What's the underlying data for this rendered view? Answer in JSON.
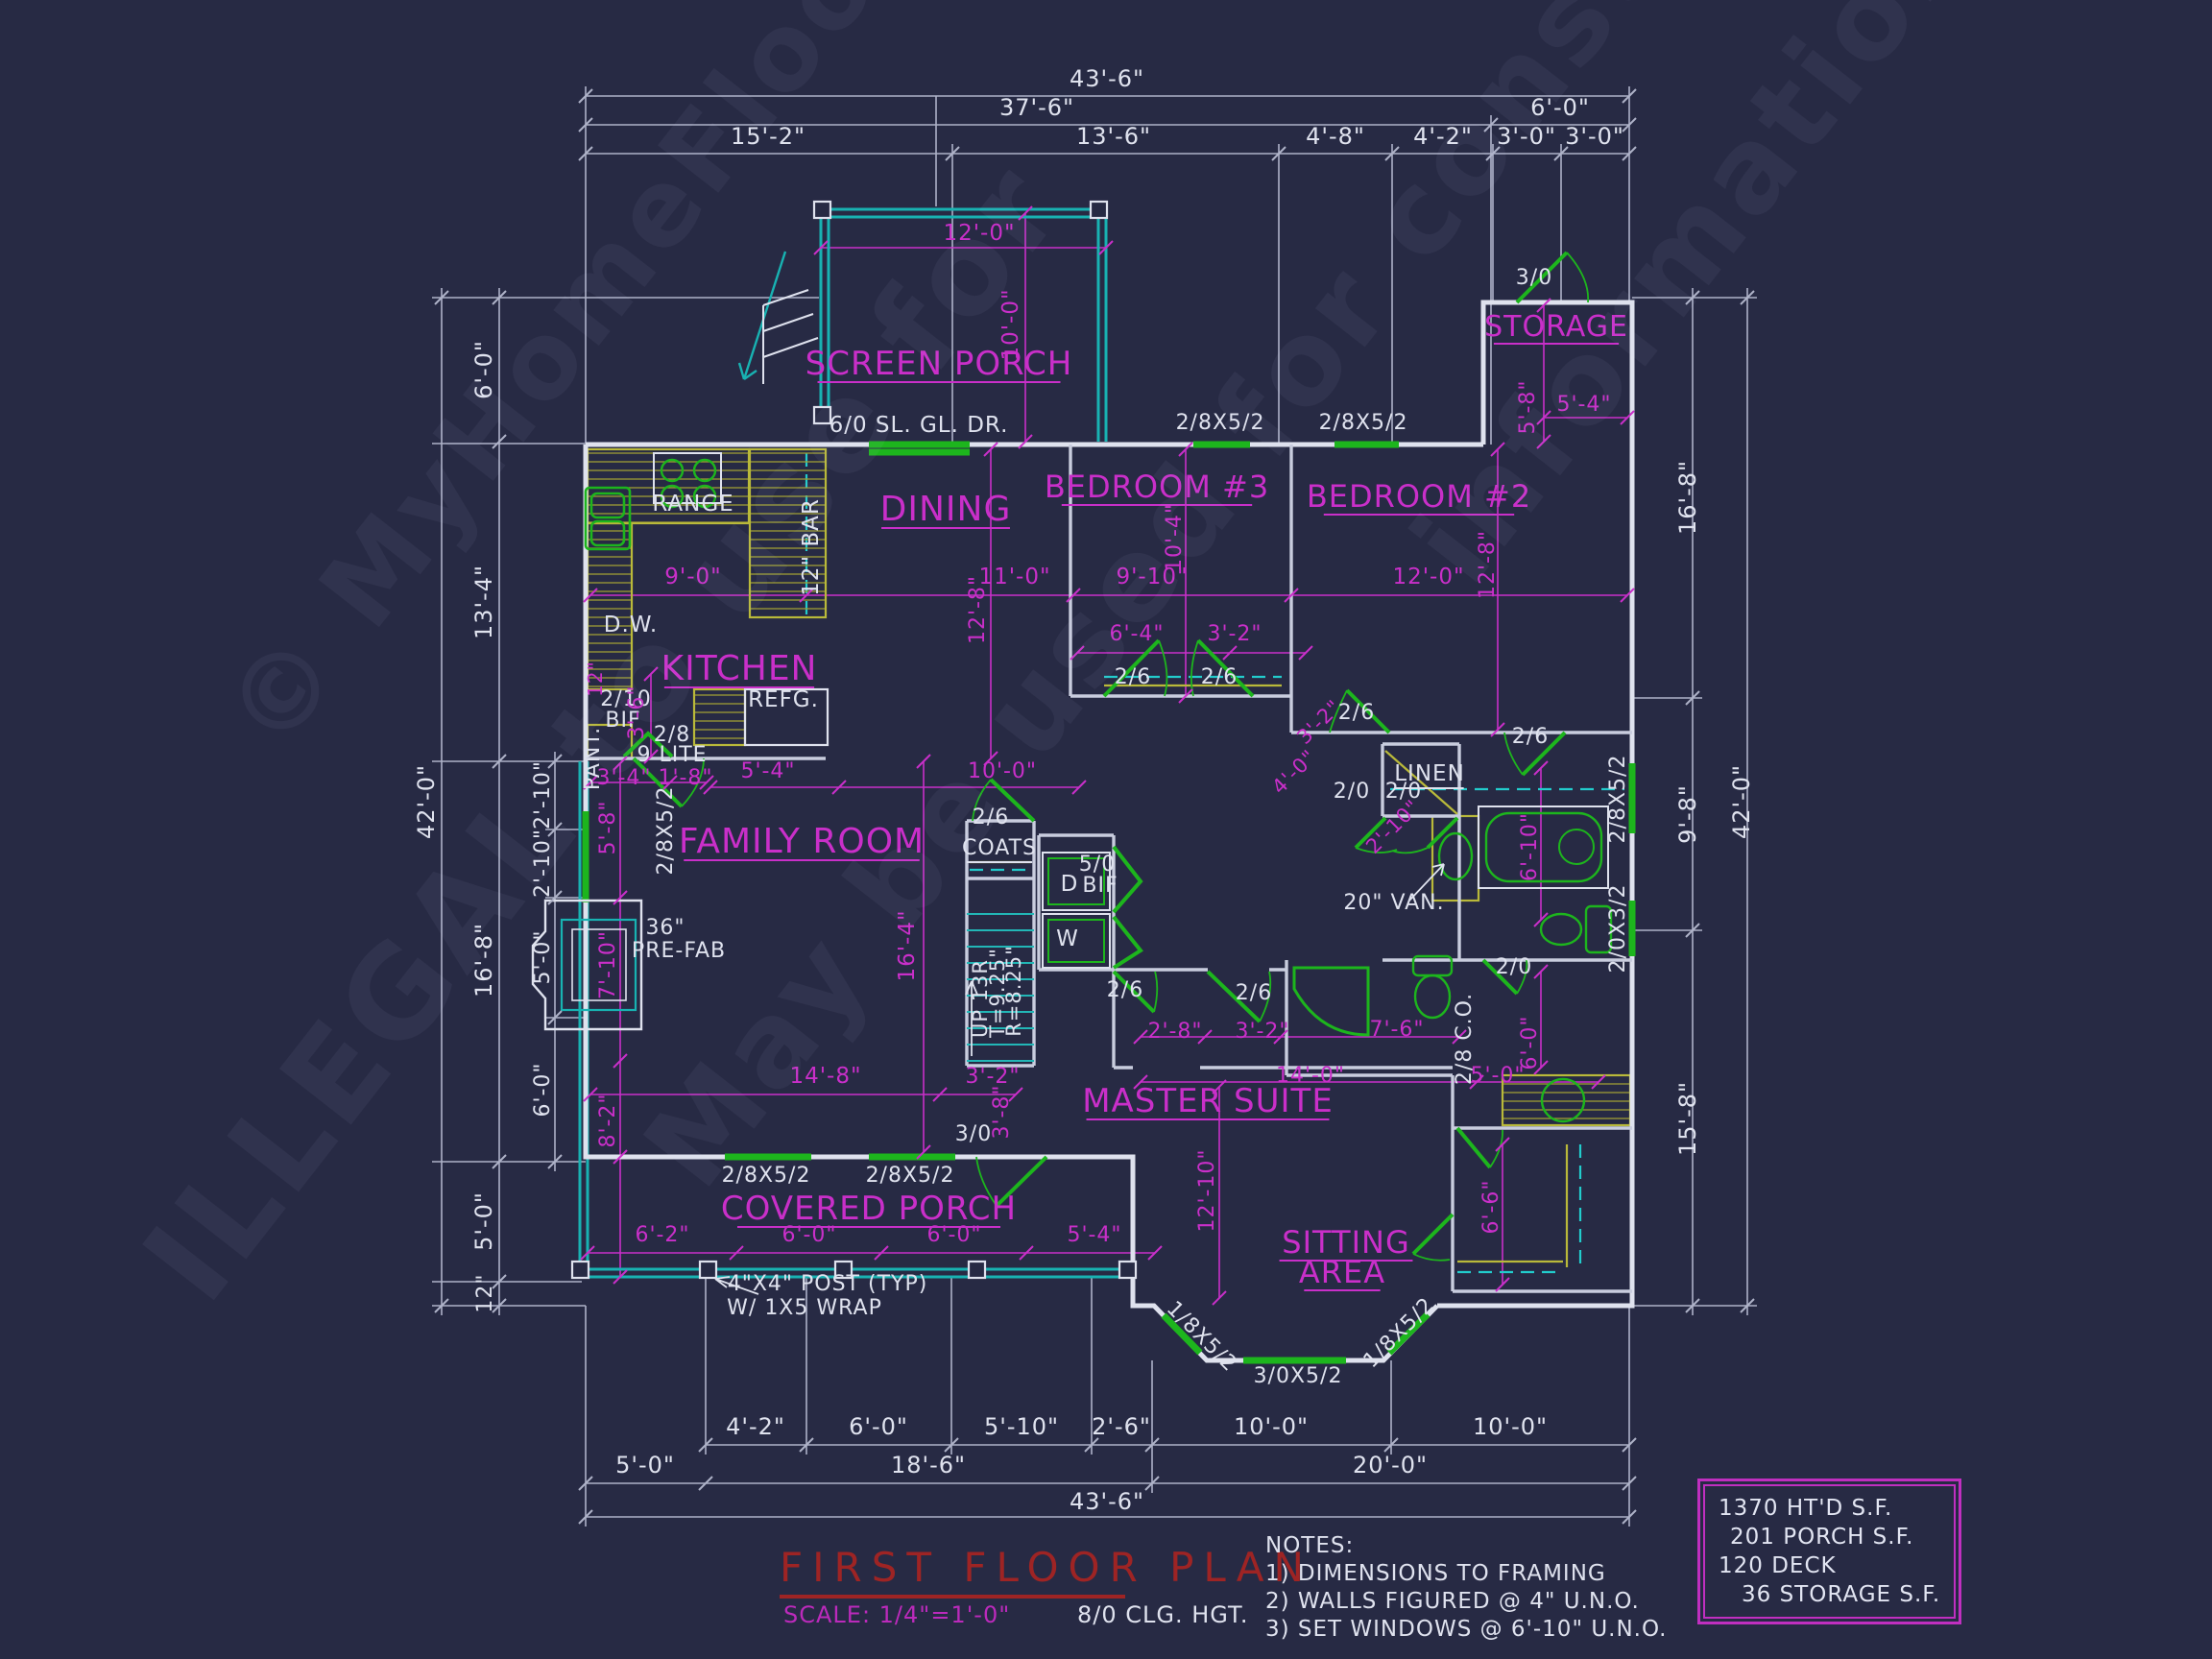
{
  "colors": {
    "background": "#272a44",
    "wall_white": "#dfe2ee",
    "dim_white": "#aeb2c8",
    "magenta": "#c92fc9",
    "green": "#1db51d",
    "cyan": "#18b2b2",
    "yellow": "#b9b93a",
    "title_red": "#9e2424"
  },
  "title_block": {
    "title": "FIRST FLOOR PLAN",
    "scale": "SCALE: 1/4\"=1'-0\"",
    "ceiling": "8/0 CLG. HGT."
  },
  "notes": {
    "heading": "NOTES:",
    "items": [
      "1)  DIMENSIONS TO FRAMING",
      "2) WALLS FIGURED @ 4\" U.N.O.",
      "3) SET WINDOWS @ 6'-10\" U.N.O."
    ]
  },
  "area_summary": {
    "lines": [
      "1370 HT'D S.F.",
      "201 PORCH S.F.",
      "120 DECK",
      "36 STORAGE S.F."
    ]
  },
  "watermark": {
    "lines": [
      "© MyHomeFloorPlans.com",
      "ILLEGAL to use for",
      "May be used for constructions",
      "informations"
    ]
  },
  "plan": {
    "labels": [
      [
        "43'-6\"",
        1153,
        90,
        24,
        "w",
        0,
        0
      ],
      [
        "37'-6\"",
        1080,
        120,
        24,
        "w",
        0,
        0
      ],
      [
        "6'-0\"",
        1625,
        120,
        24,
        "w",
        0,
        0
      ],
      [
        "15'-2\"",
        800,
        150,
        24,
        "w",
        0,
        0
      ],
      [
        "13'-6\"",
        1160,
        150,
        24,
        "w",
        0,
        0
      ],
      [
        "4'-8\"",
        1391,
        150,
        24,
        "w",
        0,
        0
      ],
      [
        "4'-2\"",
        1503,
        150,
        24,
        "w",
        0,
        0
      ],
      [
        "3'-0\"",
        1590,
        150,
        24,
        "w",
        0,
        0
      ],
      [
        "3'-0\"",
        1661,
        150,
        24,
        "w",
        0,
        0
      ],
      [
        "42'-0\"",
        452,
        835,
        24,
        "w",
        -90,
        0
      ],
      [
        "6'-0\"",
        512,
        385,
        24,
        "w",
        -90,
        0
      ],
      [
        "13'-4\"",
        512,
        627,
        24,
        "w",
        -90,
        0
      ],
      [
        "16'-8\"",
        512,
        1000,
        24,
        "w",
        -90,
        0
      ],
      [
        "5'-0\"",
        512,
        1272,
        24,
        "w",
        -90,
        0
      ],
      [
        "12\"",
        512,
        1347,
        22,
        "w",
        -90,
        0
      ],
      [
        "2'-10\"",
        572,
        828,
        22,
        "w",
        -90,
        0
      ],
      [
        "2'-10\"",
        572,
        899,
        22,
        "w",
        -90,
        0
      ],
      [
        "5'-0\"",
        572,
        997,
        22,
        "w",
        -90,
        0
      ],
      [
        "6'-0\"",
        572,
        1135,
        22,
        "w",
        -90,
        0
      ],
      [
        "16'-8\"",
        1766,
        518,
        24,
        "w",
        -90,
        0
      ],
      [
        "9'-8\"",
        1766,
        848,
        24,
        "w",
        -90,
        0
      ],
      [
        "15'-8\"",
        1766,
        1165,
        24,
        "w",
        -90,
        0
      ],
      [
        "42'-0\"",
        1822,
        835,
        24,
        "w",
        -90,
        0
      ],
      [
        "2/8X5/2",
        1692,
        832,
        22,
        "w",
        -90,
        0
      ],
      [
        "2/0X3/2",
        1692,
        967,
        22,
        "w",
        -90,
        0
      ],
      [
        "4'-2\"",
        787,
        1494,
        24,
        "w",
        0,
        0
      ],
      [
        "6'-0\"",
        915,
        1494,
        24,
        "w",
        0,
        0
      ],
      [
        "5'-10\"",
        1064,
        1494,
        24,
        "w",
        0,
        0
      ],
      [
        "2'-6\"",
        1168,
        1494,
        24,
        "w",
        0,
        0
      ],
      [
        "10'-0\"",
        1324,
        1494,
        24,
        "w",
        0,
        0
      ],
      [
        "10'-0\"",
        1573,
        1494,
        24,
        "w",
        0,
        0
      ],
      [
        "5'-0\"",
        672,
        1534,
        24,
        "w",
        0,
        0
      ],
      [
        "18'-6\"",
        967,
        1534,
        24,
        "w",
        0,
        0
      ],
      [
        "20'-0\"",
        1448,
        1534,
        24,
        "w",
        0,
        0
      ],
      [
        "43'-6\"",
        1153,
        1572,
        24,
        "w",
        0,
        0
      ],
      [
        "6/0 SL. GL. DR.",
        957,
        450,
        23,
        "w",
        0,
        0
      ],
      [
        "RANGE",
        722,
        532,
        23,
        "w",
        0,
        0
      ],
      [
        "D.W.",
        657,
        658,
        23,
        "w",
        0,
        0
      ],
      [
        "PANT.",
        624,
        790,
        22,
        "w",
        -90,
        0
      ],
      [
        "2/10",
        652,
        735,
        22,
        "w",
        0,
        0
      ],
      [
        "BIF",
        649,
        757,
        22,
        "w",
        0,
        0
      ],
      [
        "2/8",
        700,
        772,
        22,
        "w",
        0,
        0
      ],
      [
        "9 LITE",
        700,
        793,
        22,
        "w",
        0,
        0
      ],
      [
        "REFG.",
        816,
        736,
        23,
        "w",
        0,
        0
      ],
      [
        "12\" BAR",
        852,
        570,
        23,
        "w",
        -90,
        0
      ],
      [
        "36\"",
        693,
        973,
        22,
        "w",
        0,
        0
      ],
      [
        "PRE-FAB",
        707,
        997,
        22,
        "w",
        0,
        0
      ],
      [
        "2/8X5/2",
        700,
        865,
        22,
        "w",
        -90,
        0
      ],
      [
        "3/0",
        1598,
        296,
        22,
        "w",
        0,
        0
      ],
      [
        "2/6",
        1180,
        712,
        22,
        "w",
        0,
        0
      ],
      [
        "2/6",
        1270,
        712,
        22,
        "w",
        0,
        0
      ],
      [
        "2/6",
        1413,
        749,
        22,
        "w",
        0,
        0
      ],
      [
        "2/6",
        1594,
        774,
        22,
        "w",
        0,
        0
      ],
      [
        "2/0",
        1408,
        831,
        22,
        "w",
        0,
        0
      ],
      [
        "2/0",
        1462,
        831,
        22,
        "w",
        0,
        0
      ],
      [
        "LINEN",
        1489,
        813,
        23,
        "w",
        0,
        1
      ],
      [
        "20\" VAN.",
        1452,
        947,
        22,
        "w",
        0,
        0
      ],
      [
        "2/0",
        1577,
        1014,
        22,
        "w",
        0,
        0
      ],
      [
        "2/6",
        1032,
        858,
        22,
        "w",
        0,
        0
      ],
      [
        "COATS",
        1041,
        890,
        22,
        "w",
        0,
        1
      ],
      [
        "UP 13R",
        1028,
        1040,
        21,
        "w",
        -90,
        0
      ],
      [
        "T=9.25\"",
        1046,
        1034,
        21,
        "w",
        -90,
        0
      ],
      [
        "R=8.25\"",
        1063,
        1032,
        21,
        "w",
        -90,
        0
      ],
      [
        "D",
        1114,
        928,
        23,
        "w",
        0,
        0
      ],
      [
        "W",
        1112,
        985,
        23,
        "w",
        0,
        0
      ],
      [
        "5/0",
        1143,
        907,
        22,
        "w",
        0,
        0
      ],
      [
        "BIF",
        1146,
        929,
        22,
        "w",
        0,
        0
      ],
      [
        "2/6",
        1172,
        1038,
        22,
        "w",
        0,
        0
      ],
      [
        "2/6",
        1306,
        1041,
        22,
        "w",
        0,
        0
      ],
      [
        "2/8 C.O.",
        1532,
        1082,
        22,
        "w",
        -90,
        0
      ],
      [
        "3/0",
        1014,
        1188,
        22,
        "w",
        0,
        0
      ],
      [
        "2/8X5/2",
        798,
        1231,
        22,
        "w",
        0,
        0
      ],
      [
        "2/8X5/2",
        948,
        1231,
        22,
        "w",
        0,
        0
      ],
      [
        "2/8X5/2",
        1271,
        447,
        22,
        "w",
        0,
        0
      ],
      [
        "2/8X5/2",
        1420,
        447,
        22,
        "w",
        0,
        0
      ],
      [
        "1/8X5/2",
        1247,
        1397,
        22,
        "w",
        45,
        0
      ],
      [
        "3/0X5/2",
        1352,
        1440,
        22,
        "w",
        0,
        0
      ],
      [
        "1/8X5/2",
        1462,
        1393,
        22,
        "w",
        -45,
        0
      ],
      [
        "4\"X4\" POST (TYP)",
        862,
        1344,
        22,
        "w",
        0,
        0
      ],
      [
        "W/ 1X5 WRAP",
        838,
        1369,
        22,
        "w",
        0,
        0
      ],
      [
        "12'-0\"",
        1020,
        250,
        23,
        "m",
        0,
        0
      ],
      [
        "10'-0\"",
        1060,
        338,
        23,
        "m",
        -90,
        0
      ],
      [
        "5'-8\"",
        1598,
        424,
        22,
        "m",
        -90,
        0
      ],
      [
        "5'-4\"",
        1650,
        428,
        22,
        "m",
        0,
        0
      ],
      [
        "9'-0\"",
        722,
        608,
        23,
        "m",
        0,
        0
      ],
      [
        "11'-0\"",
        1057,
        608,
        23,
        "m",
        0,
        0
      ],
      [
        "12'-8\"",
        1025,
        635,
        22,
        "m",
        -90,
        0
      ],
      [
        "3'-6\"",
        670,
        742,
        22,
        "m",
        -90,
        0
      ],
      [
        "12\"",
        627,
        707,
        20,
        "m",
        -90,
        0
      ],
      [
        "3'-4\"",
        650,
        817,
        22,
        "m",
        0,
        0
      ],
      [
        "1'-8\"",
        714,
        817,
        22,
        "m",
        0,
        0
      ],
      [
        "5'-4\"",
        800,
        810,
        22,
        "m",
        0,
        0
      ],
      [
        "10'-0\"",
        1044,
        810,
        22,
        "m",
        0,
        0
      ],
      [
        "9'-10\"",
        1200,
        608,
        23,
        "m",
        0,
        0
      ],
      [
        "10'-4\"",
        1230,
        560,
        22,
        "m",
        -90,
        0
      ],
      [
        "6'-4\"",
        1184,
        667,
        22,
        "m",
        0,
        0
      ],
      [
        "3'-2\"",
        1286,
        667,
        22,
        "m",
        0,
        0
      ],
      [
        "12'-0\"",
        1488,
        608,
        23,
        "m",
        0,
        0
      ],
      [
        "12'-8\"",
        1556,
        588,
        22,
        "m",
        -90,
        0
      ],
      [
        "3'-2\"",
        1379,
        757,
        21,
        "m",
        -45,
        0
      ],
      [
        "4'-0\"",
        1353,
        809,
        21,
        "m",
        -45,
        0
      ],
      [
        "2'-10\"",
        1456,
        866,
        21,
        "m",
        -45,
        0
      ],
      [
        "6'-10\"",
        1600,
        882,
        22,
        "m",
        -90,
        0
      ],
      [
        "16'-4\"",
        952,
        985,
        23,
        "m",
        -90,
        0
      ],
      [
        "14'-8\"",
        860,
        1128,
        23,
        "m",
        0,
        0
      ],
      [
        "3'-2\"",
        1034,
        1128,
        22,
        "m",
        0,
        0
      ],
      [
        "3'-8\"",
        1050,
        1158,
        22,
        "m",
        -90,
        0
      ],
      [
        "2'-8\"",
        1224,
        1081,
        22,
        "m",
        0,
        0
      ],
      [
        "3'-2\"",
        1315,
        1081,
        22,
        "m",
        0,
        0
      ],
      [
        "7'-6\"",
        1455,
        1079,
        22,
        "m",
        0,
        0
      ],
      [
        "14'-0\"",
        1365,
        1127,
        22,
        "m",
        0,
        0
      ],
      [
        "5'-0\"",
        1560,
        1127,
        22,
        "m",
        0,
        0
      ],
      [
        "6'-0\"",
        1600,
        1086,
        22,
        "m",
        -90,
        0
      ],
      [
        "12'-10\"",
        1264,
        1240,
        22,
        "m",
        -90,
        0
      ],
      [
        "6'-6\"",
        1560,
        1257,
        22,
        "m",
        -90,
        0
      ],
      [
        "5'-8\"",
        640,
        862,
        22,
        "m",
        -90,
        0
      ],
      [
        "7'-10\"",
        640,
        1005,
        22,
        "m",
        -90,
        0
      ],
      [
        "8'-2\"",
        640,
        1167,
        22,
        "m",
        -90,
        0
      ],
      [
        "6'-2\"",
        690,
        1293,
        22,
        "m",
        0,
        0
      ],
      [
        "6'-0\"",
        843,
        1293,
        22,
        "m",
        0,
        0
      ],
      [
        "6'-0\"",
        994,
        1293,
        22,
        "m",
        0,
        0
      ],
      [
        "5'-4\"",
        1140,
        1293,
        22,
        "m",
        0,
        0
      ],
      [
        "SCREEN PORCH",
        978,
        390,
        34,
        "m",
        0,
        1
      ],
      [
        "STORAGE",
        1621,
        350,
        30,
        "m",
        0,
        1
      ],
      [
        "DINING",
        985,
        542,
        36,
        "m",
        0,
        1
      ],
      [
        "KITCHEN",
        770,
        708,
        36,
        "m",
        0,
        1
      ],
      [
        "FAMILY ROOM",
        835,
        888,
        36,
        "m",
        0,
        1
      ],
      [
        "BEDROOM #3",
        1205,
        518,
        32,
        "m",
        0,
        1
      ],
      [
        "BEDROOM #2",
        1478,
        528,
        32,
        "m",
        0,
        1
      ],
      [
        "MASTER SUITE",
        1258,
        1158,
        34,
        "m",
        0,
        1
      ],
      [
        "SITTING",
        1402,
        1305,
        32,
        "m",
        0,
        1
      ],
      [
        "AREA",
        1398,
        1336,
        32,
        "m",
        0,
        1
      ],
      [
        "COVERED PORCH",
        905,
        1270,
        34,
        "m",
        0,
        1
      ]
    ]
  }
}
